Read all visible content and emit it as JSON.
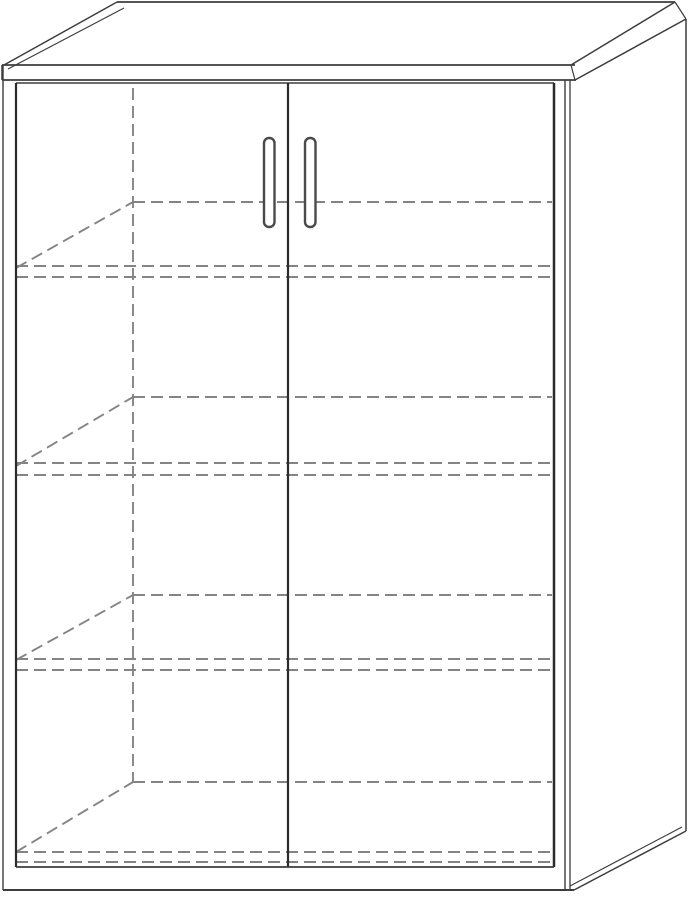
{
  "figure": {
    "type": "line-drawing",
    "subject": "two-door storage cabinet, perspective view, four hidden shelf levels drawn as dashed lines",
    "canvas": {
      "width": 691,
      "height": 900,
      "background": "#ffffff"
    },
    "colors": {
      "outline": "#3d3d3d",
      "door_edge": "#2b2b2b",
      "hidden": "#848484",
      "handle": "#4a4a4a",
      "fill": "#ffffff"
    },
    "dash_pattern": "12 6",
    "hidden_line_width": 1.9,
    "solid_lines": [
      {
        "name": "top-back-edge",
        "x1": 117,
        "y1": 2,
        "x2": 675,
        "y2": 2,
        "w": 1.8
      },
      {
        "name": "top-left-outer-edge",
        "x1": 4,
        "y1": 65,
        "x2": 117,
        "y2": 2,
        "w": 1.5
      },
      {
        "name": "top-left-inner-edge",
        "x1": 8,
        "y1": 69,
        "x2": 124,
        "y2": 8,
        "w": 1.2
      },
      {
        "name": "top-front-edge",
        "x1": 2,
        "y1": 65,
        "x2": 575,
        "y2": 65,
        "w": 1.8
      },
      {
        "name": "top-band-bottom-edge",
        "x1": 2,
        "y1": 80,
        "x2": 576,
        "y2": 80,
        "w": 1.7
      },
      {
        "name": "top-band-left-cap",
        "x1": 2,
        "y1": 65,
        "x2": 2,
        "y2": 80,
        "w": 1.5
      },
      {
        "name": "top-band-right-cap",
        "x1": 571,
        "y1": 65,
        "x2": 575,
        "y2": 80,
        "w": 1.2
      },
      {
        "name": "top-right-outer-edge",
        "x1": 571,
        "y1": 65,
        "x2": 675,
        "y2": 2,
        "w": 1.5
      },
      {
        "name": "top-right-inner-edge",
        "x1": 575,
        "y1": 80,
        "x2": 686,
        "y2": 19,
        "w": 1.5
      },
      {
        "name": "top-back-right-cap",
        "x1": 675,
        "y1": 2,
        "x2": 686,
        "y2": 19,
        "w": 1.2
      },
      {
        "name": "left-outer-edge",
        "x1": 3,
        "y1": 65,
        "x2": 3,
        "y2": 890,
        "w": 1.4
      },
      {
        "name": "door-top-edge",
        "x1": 16,
        "y1": 83,
        "x2": 554,
        "y2": 83,
        "w": 1.4
      },
      {
        "name": "left-door-left-edge",
        "x1": 16,
        "y1": 83,
        "x2": 16,
        "y2": 867,
        "w": 2.2,
        "dark": true
      },
      {
        "name": "door-center-gap",
        "x1": 288,
        "y1": 83,
        "x2": 288,
        "y2": 867,
        "w": 2.2,
        "dark": true
      },
      {
        "name": "right-door-right-edge",
        "x1": 554,
        "y1": 83,
        "x2": 554,
        "y2": 867,
        "w": 2.5,
        "dark": true
      },
      {
        "name": "door-bottom-edge",
        "x1": 16,
        "y1": 867,
        "x2": 554,
        "y2": 867,
        "w": 1.8
      },
      {
        "name": "base-bottom-edge",
        "x1": 3,
        "y1": 890,
        "x2": 574,
        "y2": 890,
        "w": 2.0
      },
      {
        "name": "front-right-corner-edge",
        "x1": 565,
        "y1": 80,
        "x2": 565,
        "y2": 890,
        "w": 1.4
      },
      {
        "name": "side-front-edge",
        "x1": 570,
        "y1": 80,
        "x2": 570,
        "y2": 890,
        "w": 1.3
      },
      {
        "name": "side-back-edge",
        "x1": 686,
        "y1": 19,
        "x2": 686,
        "y2": 831,
        "w": 1.5
      },
      {
        "name": "side-bottom-outer-edge",
        "x1": 574,
        "y1": 890,
        "x2": 686,
        "y2": 831,
        "w": 1.5
      },
      {
        "name": "side-bottom-inner-edge",
        "x1": 570,
        "y1": 886,
        "x2": 682,
        "y2": 827,
        "w": 1.2
      }
    ],
    "dashed_lines": [
      {
        "name": "interior-back-corner-vertical",
        "x1": 133,
        "y1": 88,
        "x2": 133,
        "y2": 782
      },
      {
        "name": "shelf1-back-edge",
        "x1": 133,
        "y1": 202,
        "x2": 552,
        "y2": 202
      },
      {
        "name": "shelf2-back-edge",
        "x1": 133,
        "y1": 397,
        "x2": 552,
        "y2": 397
      },
      {
        "name": "shelf3-back-edge",
        "x1": 133,
        "y1": 595,
        "x2": 552,
        "y2": 595
      },
      {
        "name": "bottom-panel-back-edge",
        "x1": 133,
        "y1": 782,
        "x2": 552,
        "y2": 782
      },
      {
        "name": "shelf1-left-edge-diagonal",
        "x1": 16,
        "y1": 268,
        "x2": 133,
        "y2": 202
      },
      {
        "name": "shelf2-left-edge-diagonal",
        "x1": 16,
        "y1": 466,
        "x2": 133,
        "y2": 397
      },
      {
        "name": "shelf3-left-edge-diagonal",
        "x1": 16,
        "y1": 660,
        "x2": 133,
        "y2": 595
      },
      {
        "name": "bottom-panel-left-edge-diagonal",
        "x1": 16,
        "y1": 852,
        "x2": 133,
        "y2": 782
      },
      {
        "name": "shelf1-front-top-edge",
        "x1": 16,
        "y1": 266,
        "x2": 552,
        "y2": 266
      },
      {
        "name": "shelf1-front-bottom-edge",
        "x1": 16,
        "y1": 277,
        "x2": 552,
        "y2": 277
      },
      {
        "name": "shelf2-front-top-edge",
        "x1": 16,
        "y1": 463,
        "x2": 552,
        "y2": 463
      },
      {
        "name": "shelf2-front-bottom-edge",
        "x1": 16,
        "y1": 475,
        "x2": 552,
        "y2": 475
      },
      {
        "name": "shelf3-front-top-edge",
        "x1": 16,
        "y1": 659,
        "x2": 552,
        "y2": 659
      },
      {
        "name": "shelf3-front-bottom-edge",
        "x1": 16,
        "y1": 670,
        "x2": 552,
        "y2": 670
      },
      {
        "name": "bottom-panel-front-top-edge",
        "x1": 16,
        "y1": 852,
        "x2": 552,
        "y2": 852
      },
      {
        "name": "bottom-panel-front-bottom-edge",
        "x1": 16,
        "y1": 862,
        "x2": 552,
        "y2": 862
      }
    ],
    "handles": [
      {
        "name": "left-door-handle",
        "x": 264,
        "y": 138,
        "w": 10.5,
        "h": 89,
        "rx": 5,
        "stroke_w": 2.4
      },
      {
        "name": "right-door-handle",
        "x": 305,
        "y": 138,
        "w": 10.5,
        "h": 89,
        "rx": 5,
        "stroke_w": 2.4
      }
    ]
  }
}
